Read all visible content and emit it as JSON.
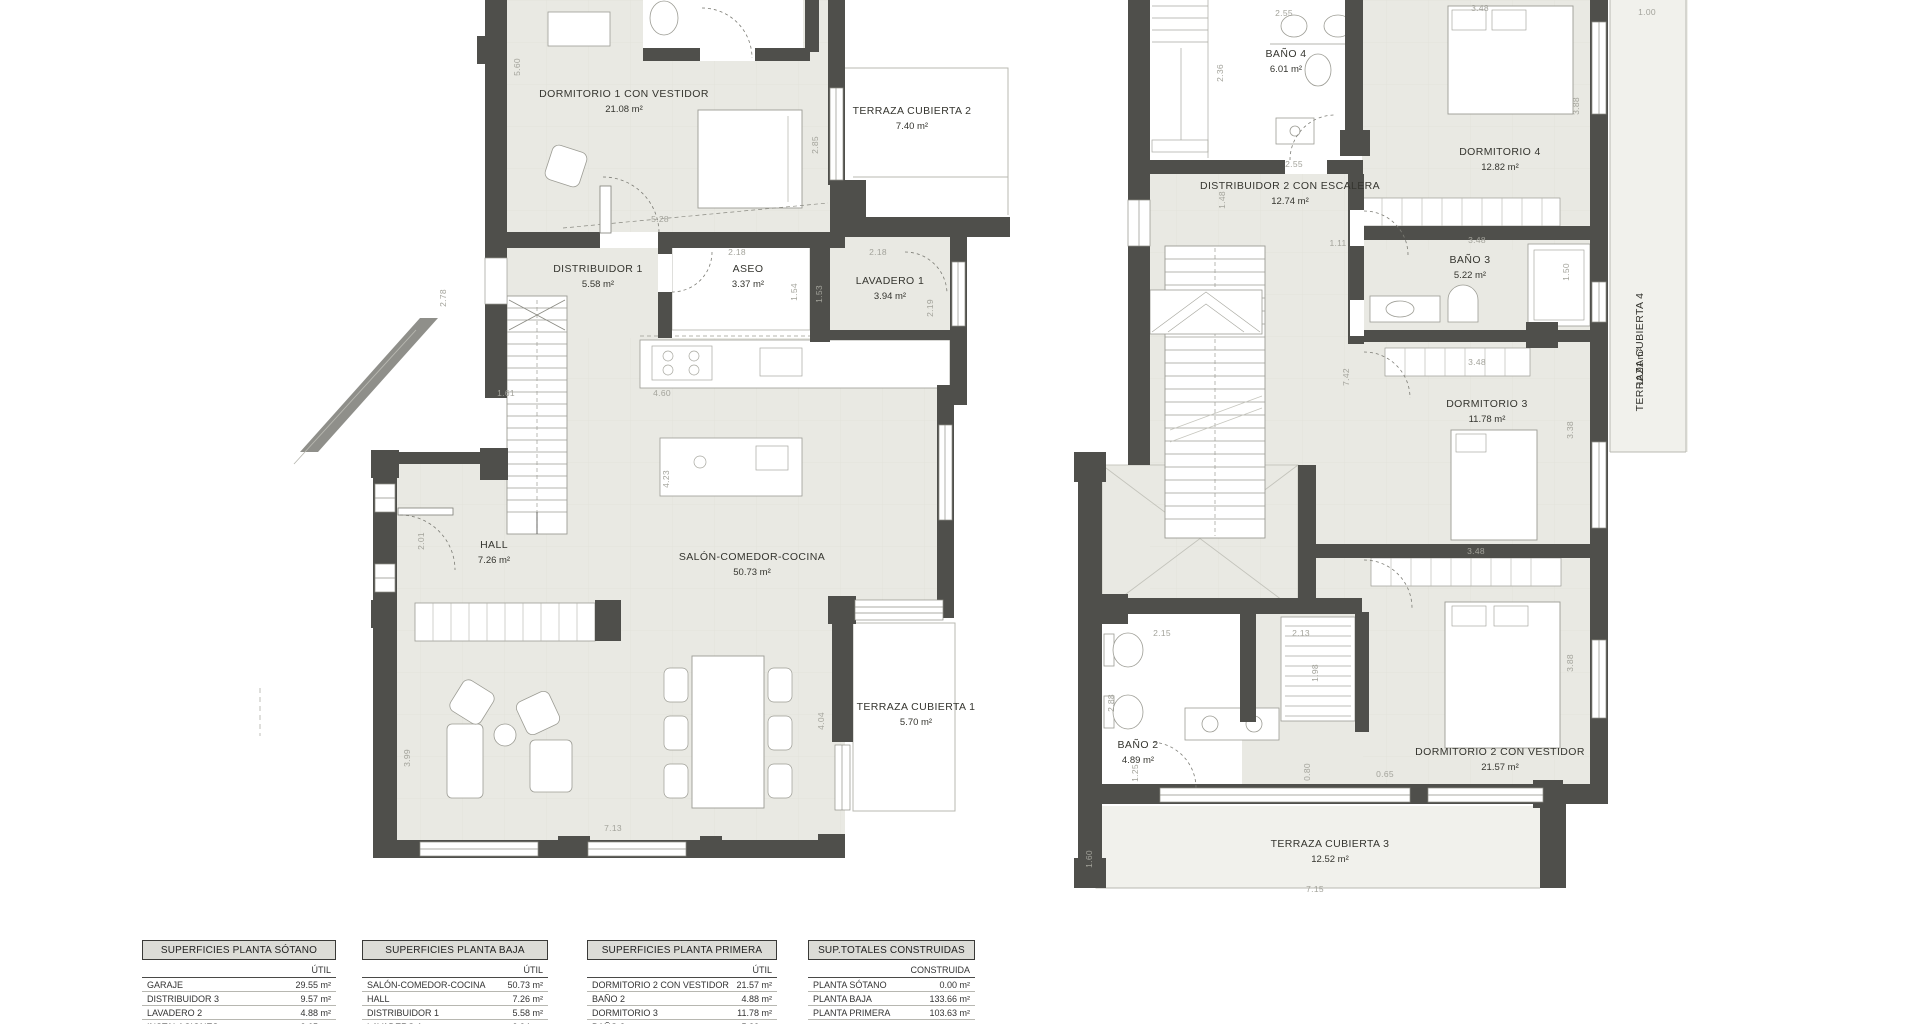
{
  "plans": [
    {
      "id": "planta-baja",
      "rooms": [
        {
          "n": "DORMITORIO 1 CON VESTIDOR",
          "a": "21.08 m²",
          "x": 624,
          "y": 97
        },
        {
          "n": "TERRAZA CUBIERTA 2",
          "a": "7.40 m²",
          "x": 912,
          "y": 114
        },
        {
          "n": "DISTRIBUIDOR 1",
          "a": "5.58 m²",
          "x": 598,
          "y": 272
        },
        {
          "n": "ASEO",
          "a": "3.37 m²",
          "x": 748,
          "y": 272
        },
        {
          "n": "LAVADERO 1",
          "a": "3.94 m²",
          "x": 890,
          "y": 284
        },
        {
          "n": "HALL",
          "a": "7.26 m²",
          "x": 494,
          "y": 548
        },
        {
          "n": "SALÓN-COMEDOR-COCINA",
          "a": "50.73 m²",
          "x": 752,
          "y": 560
        },
        {
          "n": "TERRAZA CUBIERTA 1",
          "a": "5.70 m²",
          "x": 916,
          "y": 710
        }
      ],
      "dims": [
        {
          "t": "5.60",
          "x": 520,
          "y": 67,
          "r": -90
        },
        {
          "t": "5.28",
          "x": 660,
          "y": 222
        },
        {
          "t": "2.85",
          "x": 818,
          "y": 145,
          "r": -90
        },
        {
          "t": "2.18",
          "x": 737,
          "y": 255
        },
        {
          "t": "2.18",
          "x": 878,
          "y": 255
        },
        {
          "t": "1.54",
          "x": 797,
          "y": 292,
          "r": -90
        },
        {
          "t": "1.53",
          "x": 822,
          "y": 294,
          "r": -90
        },
        {
          "t": "2.19",
          "x": 933,
          "y": 308,
          "r": -90
        },
        {
          "t": "2.78",
          "x": 446,
          "y": 298,
          "r": -90
        },
        {
          "t": "1.61",
          "x": 506,
          "y": 396
        },
        {
          "t": "4.60",
          "x": 662,
          "y": 396
        },
        {
          "t": "4.23",
          "x": 669,
          "y": 479,
          "r": -90
        },
        {
          "t": "2.01",
          "x": 424,
          "y": 541,
          "r": -90
        },
        {
          "t": "4.04",
          "x": 824,
          "y": 721,
          "r": -90
        },
        {
          "t": "3.99",
          "x": 410,
          "y": 758,
          "r": -90
        },
        {
          "t": "7.13",
          "x": 613,
          "y": 831
        }
      ]
    },
    {
      "id": "planta-primera",
      "rooms": [
        {
          "n": "BAÑO 4",
          "a": "6.01 m²",
          "x": 1286,
          "y": 57
        },
        {
          "n": "DORMITORIO 4",
          "a": "12.82 m²",
          "x": 1500,
          "y": 155
        },
        {
          "n": "DISTRIBUIDOR 2 CON ESCALERA",
          "a": "12.74 m²",
          "x": 1290,
          "y": 189
        },
        {
          "n": "BAÑO 3",
          "a": "5.22 m²",
          "x": 1470,
          "y": 263
        },
        {
          "n": "DORMITORIO 3",
          "a": "11.78 m²",
          "x": 1487,
          "y": 407
        },
        {
          "n": "DORMITORIO 2 CON VESTIDOR",
          "a": "21.57 m²",
          "x": 1500,
          "y": 755
        },
        {
          "n": "BAÑO 2",
          "a": "4.89 m²",
          "x": 1138,
          "y": 748
        },
        {
          "n": "TERRAZA CUBIERTA 3",
          "a": "12.52 m²",
          "x": 1330,
          "y": 847
        },
        {
          "n": "TERRAZA CUBIERTA 4",
          "a": "12.91 m²",
          "x": 1643,
          "y": 352,
          "r": -90
        }
      ],
      "dims": [
        {
          "t": "2.55",
          "x": 1284,
          "y": 16
        },
        {
          "t": "3.48",
          "x": 1480,
          "y": 11
        },
        {
          "t": "1.00",
          "x": 1647,
          "y": 15
        },
        {
          "t": "2.36",
          "x": 1223,
          "y": 73,
          "r": -90
        },
        {
          "t": "3.88",
          "x": 1579,
          "y": 106,
          "r": -90
        },
        {
          "t": "2.55",
          "x": 1294,
          "y": 167
        },
        {
          "t": "1.48",
          "x": 1225,
          "y": 200,
          "r": -90
        },
        {
          "t": "1.11",
          "x": 1338,
          "y": 246
        },
        {
          "t": "3.48",
          "x": 1477,
          "y": 243
        },
        {
          "t": "1.50",
          "x": 1569,
          "y": 272,
          "r": -90
        },
        {
          "t": "7.42",
          "x": 1349,
          "y": 377,
          "r": -90
        },
        {
          "t": "3.48",
          "x": 1477,
          "y": 365
        },
        {
          "t": "3.38",
          "x": 1573,
          "y": 430,
          "r": -90
        },
        {
          "t": "3.48",
          "x": 1476,
          "y": 554
        },
        {
          "t": "3.88",
          "x": 1573,
          "y": 663,
          "r": -90
        },
        {
          "t": "2.15",
          "x": 1162,
          "y": 636
        },
        {
          "t": "2.13",
          "x": 1301,
          "y": 636
        },
        {
          "t": "2.88",
          "x": 1114,
          "y": 703,
          "r": -90
        },
        {
          "t": "1.98",
          "x": 1318,
          "y": 673,
          "r": -90
        },
        {
          "t": "1.25",
          "x": 1138,
          "y": 773,
          "r": -90
        },
        {
          "t": "0.80",
          "x": 1310,
          "y": 772,
          "r": -90
        },
        {
          "t": "0.65",
          "x": 1385,
          "y": 777
        },
        {
          "t": "1.60",
          "x": 1092,
          "y": 859,
          "r": -90
        },
        {
          "t": "7.15",
          "x": 1315,
          "y": 892
        }
      ]
    }
  ],
  "tables": [
    {
      "title": "SUPERFICIES PLANTA SÓTANO",
      "col": "ÚTIL",
      "rows": [
        [
          "GARAJE",
          "29.55 m²"
        ],
        [
          "DISTRIBUIDOR 3",
          "9.57 m²"
        ],
        [
          "LAVADERO 2",
          "4.88 m²"
        ],
        [
          "INSTALACIONES",
          "2.65 m²"
        ]
      ]
    },
    {
      "title": "SUPERFICIES PLANTA BAJA",
      "col": "ÚTIL",
      "rows": [
        [
          "SALÓN-COMEDOR-COCINA",
          "50.73 m²"
        ],
        [
          "HALL",
          "7.26 m²"
        ],
        [
          "DISTRIBUIDOR 1",
          "5.58 m²"
        ],
        [
          "LAVADERO 1",
          "3.94 m²"
        ]
      ]
    },
    {
      "title": "SUPERFICIES PLANTA PRIMERA",
      "col": "ÚTIL",
      "rows": [
        [
          "DORMITORIO 2 CON VESTIDOR",
          "21.57 m²"
        ],
        [
          "BAÑO 2",
          "4.88 m²"
        ],
        [
          "DORMITORIO 3",
          "11.78 m²"
        ],
        [
          "BAÑO 3",
          "5.22 m²"
        ]
      ]
    },
    {
      "title": "SUP.TOTALES CONSTRUIDAS",
      "col": "CONSTRUIDA",
      "rows": [
        [
          "PLANTA SÓTANO",
          "0.00 m²"
        ],
        [
          "PLANTA BAJA",
          "133.66 m²"
        ],
        [
          "PLANTA PRIMERA",
          "103.63 m²"
        ]
      ]
    }
  ]
}
